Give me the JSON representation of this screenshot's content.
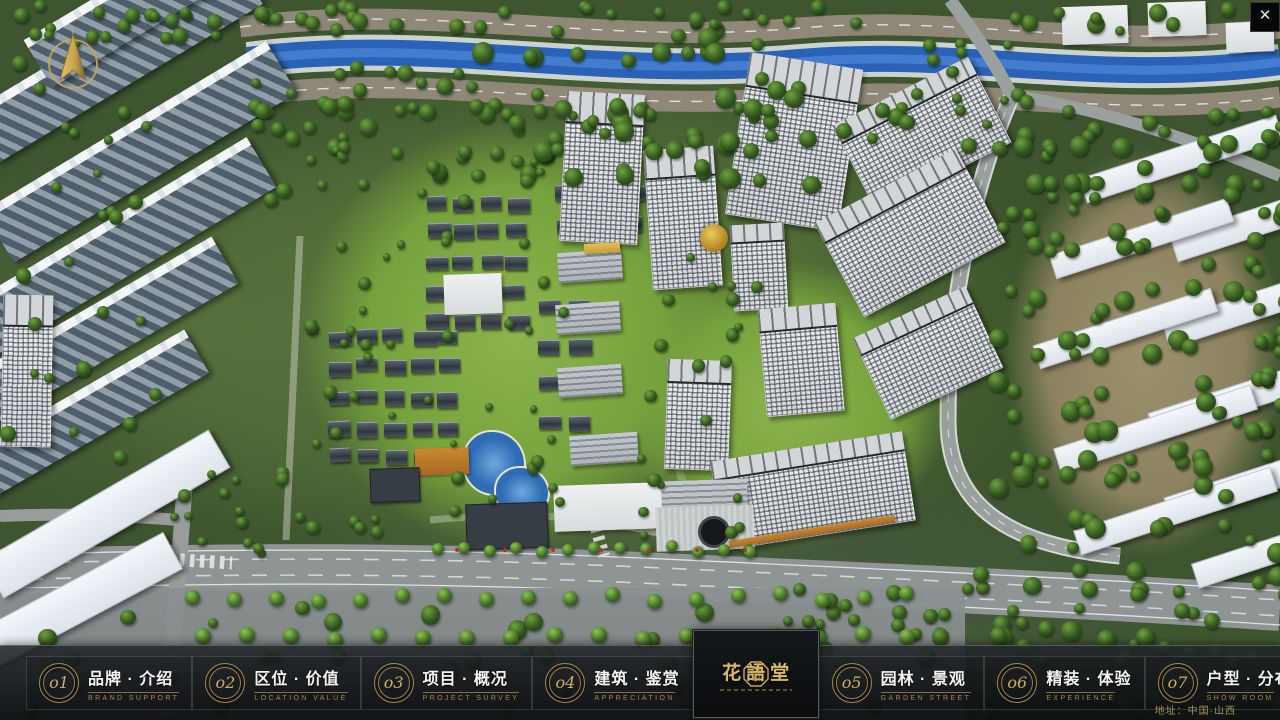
{
  "window": {
    "close_icon": "✕"
  },
  "navbar": {
    "items": [
      {
        "num": "o1",
        "zh": "品牌 · 介绍",
        "en": "BRAND SUPPORT"
      },
      {
        "num": "o2",
        "zh": "区位 · 价值",
        "en": "LOCATION VALUE"
      },
      {
        "num": "o3",
        "zh": "项目 · 概况",
        "en": "PROJECT SURVEY"
      },
      {
        "num": "o4",
        "zh": "建筑 · 鉴赏",
        "en": "APPRECIATION"
      },
      {
        "num": "o5",
        "zh": "园林 · 景观",
        "en": "GARDEN STREET"
      },
      {
        "num": "o6",
        "zh": "精装 · 体验",
        "en": "EXPERIENCE"
      },
      {
        "num": "o7",
        "zh": "户型 · 分布",
        "en": "SHOW ROOM"
      },
      {
        "num": "o8",
        "zh": "一房 · 一景",
        "en": "COMMUNITY"
      }
    ]
  },
  "logo": {
    "title": "花語堂"
  },
  "footer": {
    "address": "地址：中国·山西"
  },
  "colors": {
    "gold": "#c9a857",
    "bar_bg": "#14181b",
    "river": "#2a62b8",
    "road": "#8f8878"
  }
}
